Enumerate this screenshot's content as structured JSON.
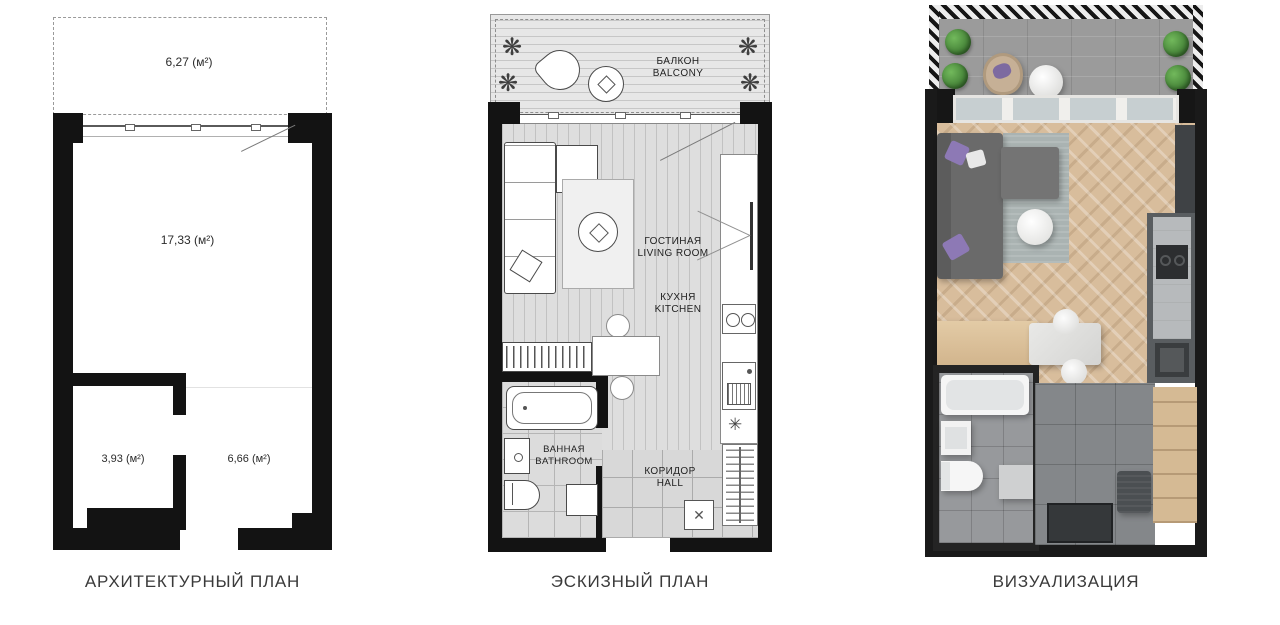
{
  "captions": {
    "architectural": "АРХИТЕКТУРНЫЙ ПЛАН",
    "sketch": "ЭСКИЗНЫЙ ПЛАН",
    "visualization": "ВИЗУАЛИЗАЦИЯ"
  },
  "architectural_plan": {
    "balcony_area": "6,27 (м²)",
    "living_area": "17,33 (м²)",
    "bathroom_area": "3,93 (м²)",
    "hall_area": "6,66 (м²)"
  },
  "sketch_plan": {
    "balcony_ru": "БАЛКОН",
    "balcony_en": "BALCONY",
    "living_ru": "ГОСТИНАЯ",
    "living_en": "LIVING ROOM",
    "kitchen_ru": "КУХНЯ",
    "kitchen_en": "KITCHEN",
    "bathroom_ru": "ВАННАЯ",
    "bathroom_en": "BATHROOM",
    "hall_ru": "КОРИДОР",
    "hall_en": "HALL"
  },
  "icons": {
    "plant": "❋",
    "snowflake": "✳",
    "cross": "✕"
  },
  "colors": {
    "wall": "#131313",
    "accent_purple": "#8d79b5",
    "wood_floor": "#d8bd9c",
    "plant_green": "#4c8c3f",
    "background": "#ffffff"
  }
}
